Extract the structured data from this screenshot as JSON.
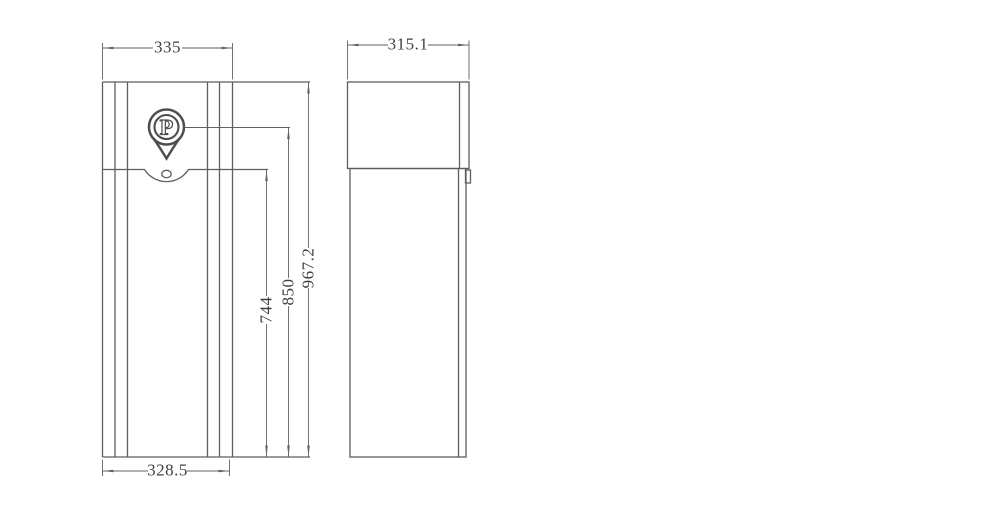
{
  "drawing": {
    "background": "#ffffff",
    "line_color": "#5d5e60",
    "dim_color": "#626262",
    "text_color": "#3f3f3f",
    "front_view": {
      "logo_letter": "P",
      "dims": {
        "top_width": "335",
        "bottom_width": "328.5",
        "body_height": "744",
        "logo_height": "850",
        "total_height": "967.2"
      }
    },
    "side_view": {
      "dims": {
        "top_width": "315.1"
      }
    }
  }
}
